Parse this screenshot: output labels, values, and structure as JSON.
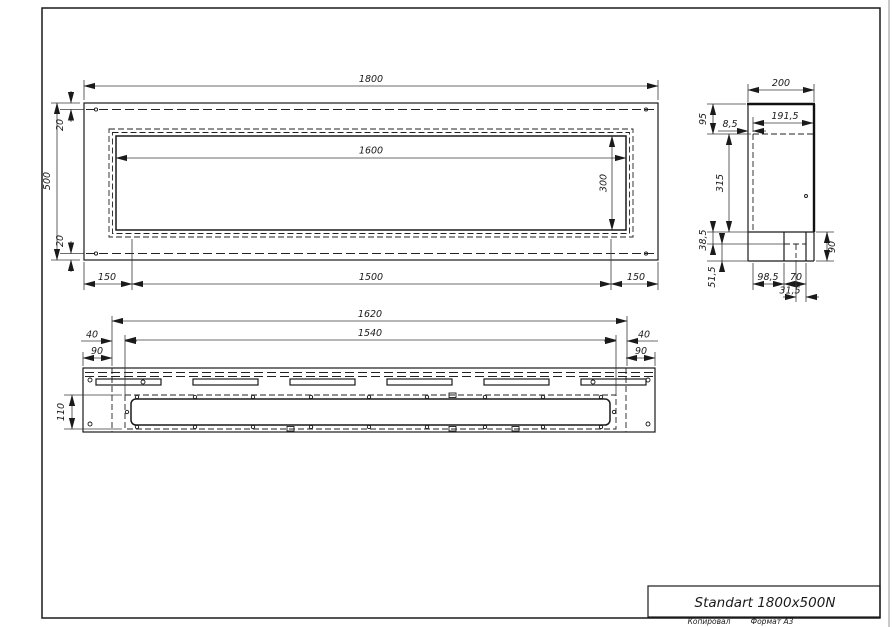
{
  "title_block": {
    "product_title": "Standart 1800x500N"
  },
  "footer": {
    "copied_label": "Копировал",
    "format_label": "Формат А3"
  },
  "front_view": {
    "total_width": "1800",
    "total_height": "500",
    "flange_top": "20",
    "flange_bottom": "20",
    "opening_width": "1600",
    "opening_height": "300",
    "offset_left": "150",
    "center_span": "1500",
    "offset_right": "150"
  },
  "side_view": {
    "depth": "200",
    "inner_depth": "191,5",
    "wall_offset": "8,5",
    "top_section": "95",
    "mid_section": "315",
    "lip": "38,5",
    "base": "51,5",
    "tray_len": "98,5",
    "tray_mid": "70",
    "tray_end": "31,5",
    "tray_height": "90"
  },
  "top_view": {
    "body_length": "1620",
    "burner_length": "1540",
    "gap_left": "40",
    "gap_right": "40",
    "cap_left": "90",
    "cap_right": "90",
    "tray_width": "110"
  },
  "colors": {
    "line": "#1a1a1a",
    "dim": "#3a3a3a",
    "background": "#ffffff"
  }
}
